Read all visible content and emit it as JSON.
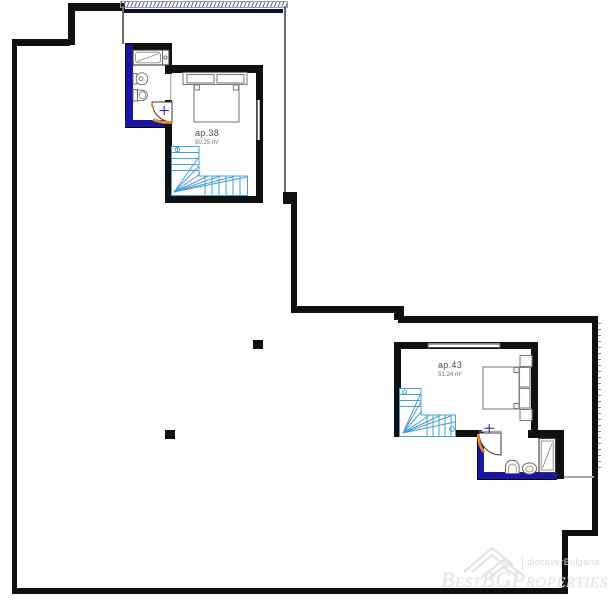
{
  "plan": {
    "type": "floor-plan",
    "apartments": [
      {
        "id": "ap38",
        "label": "ap.38",
        "area": "50.25 m²"
      },
      {
        "id": "ap43",
        "label": "ap.43",
        "area": "51.24 m²"
      }
    ],
    "colors": {
      "wall_black": "#101010",
      "insulated_wall_navy": "#1816a2",
      "door_orange": "#ef8d25",
      "stair_blue": "#49a0d8",
      "furniture_gray": "#828282",
      "railing_hatch_blue": "#5a5ad0",
      "watermark_gray": "#e7e7e7"
    }
  },
  "watermark": {
    "brand": "BestBGProperties",
    "tagline": "discoverBulgaria"
  }
}
